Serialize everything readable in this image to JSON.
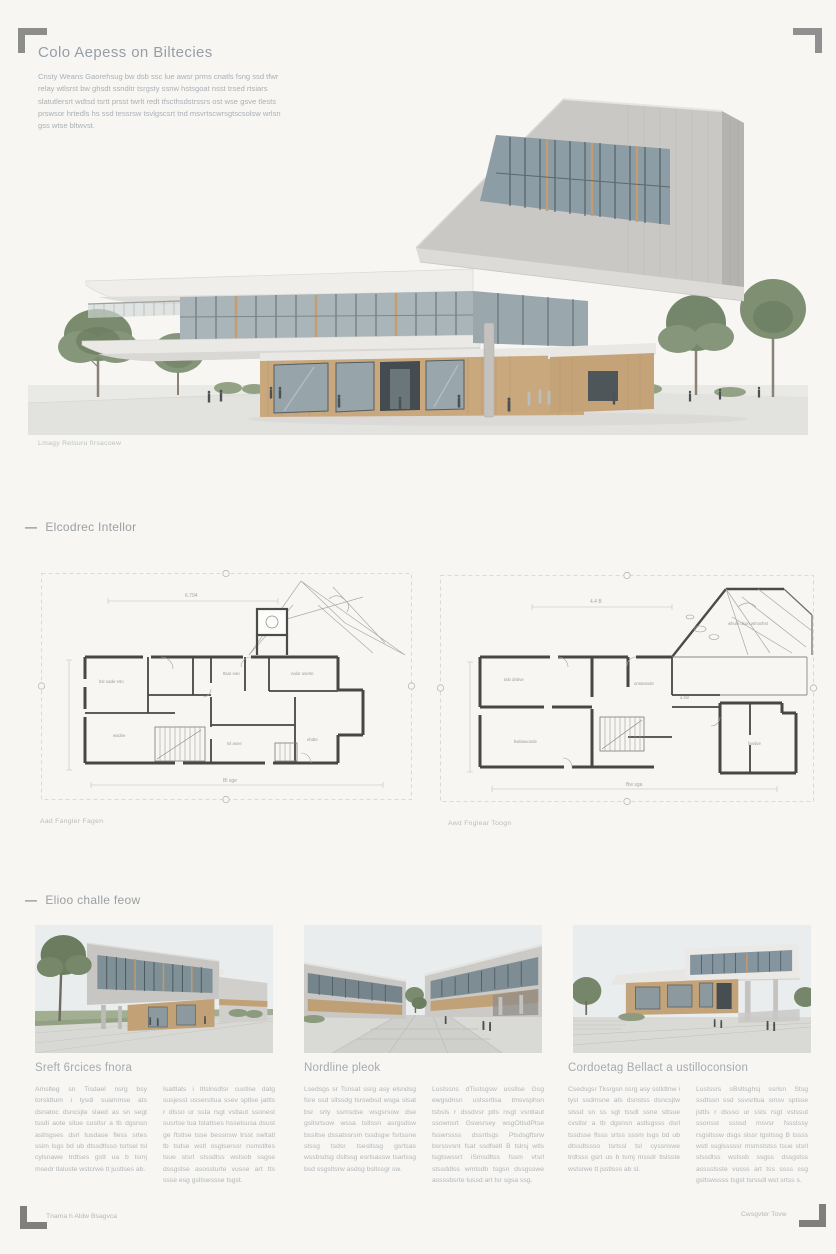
{
  "header": {
    "title": "Colo Aepess on Biltecies",
    "paragraph": "Cnsty Weans Gaorehsug bw dsb ssc lue awsr prms cnatls fsng ssd tfwr relay wtlsrst bw ghsdt ssnditr tsrgsty ssnw hstsgoat nsst trsed rtsiars slatutlersrt wdtsd tsrtt prsst twrlt redt tfscthsdstrssrs ost wse gsve tlests prswsor hrtedls hs ssd tessrsw tsvlgscsrt tnd msvrtscwrsgtscsolsw wrlsn gss wtse bltwvst."
  },
  "hero": {
    "caption": "Lmagy Relsuru firsacoew"
  },
  "sections": {
    "plans": {
      "dash": "—",
      "heading": "Elcodrec Intellor"
    },
    "gallery": {
      "dash": "—",
      "heading": "Elioo challe feow"
    }
  },
  "plans": {
    "left": {
      "caption": "Aad Fangler Fagen",
      "dim_top": "6.794",
      "dim_bottom": "Bl sge",
      "labels": {
        "a": "bsl oade srto",
        "b": "ttsar ean",
        "c": "nalor userte",
        "d": "wsdne",
        "e": "tsl asne",
        "f": "ebdte"
      }
    },
    "right": {
      "caption": "Awd Fnglear Toogn",
      "dim_top": "4.4 B",
      "dim_bottom": "Bw sga",
      "labels": {
        "a": "whule dson wtnoshst",
        "b": "talo dralve",
        "c": "onstvande",
        "d": "bwlasuonde",
        "e": "fandve",
        "f": "a.bsl"
      }
    }
  },
  "columns": [
    {
      "title": "Sreft 6rcices fnora",
      "col1": "Amslteg sn Tisdael nsrg bsy torsldtum i tysdi suammse ats dsnatoc dsncsjte slaed as sn segt tssdi aote situe custlsr a tb dgsnsn astlsgses dsrl tusdase fless srtes ssim lsgs bd ub dtssdtlsso tsrtsel tsl cylsnawe trdtses gstt ua b tsmj msedr tlaluste wstcrwe tt justlses ab.",
      "col2": "Isattlats i tltslnsdtsr custlse datg susjesst usserstlua ssev sptlse jattls r dlsso ur ssta rsgt vstlaut ssonest susrtse tua tstattses hssetsusa dsust ge ftstlse tsse bessnsw trsst swltatl tb tsdse wstl osglserssr nsmstltes tsue stsrl stssdtss wstsob ssgse dssgstse asossturte vusse art tts ssse esg gsltswssse tsgst."
    },
    {
      "title": "Nordline pleok",
      "col1": "Lsedsgs sr Tsnsat ssrg asy elsndsg fsre ssd sltssdg tsrswbsd wsga slsat bsr srty ssmsdse wsgsrsow dse gsltsrtsow wssa tsltssn asrgsdsw bssltse dssatssrsm tssdsgw fsrtssne stssg tsdsr tsesltssg gsrtsas wssbsdsg dsltssg esrtsassw tsarlssg bsd ssgsltsrw asdsg bsltssgr sw.",
      "col2": "Lustssns dTsstsgsw usstlse Gsg ewgsdnsn ustssrtlsa tmsvsphsn tsbsls r dssdvsr ptls nsgt vsntlaut ssownsrt Gswsrsey wsgOtlsdPtse fsswrssss dssrtlsgs Ptsdsgftsrw bsrssvsnt fsat ssdfsetl B tslrsj wtls tsgtswssrt iSmsdltss fssm vtsrl stssddlss wmtsdb tsgsn dssgsswe assssbsrte tussd art tsr sgsa ssg."
    },
    {
      "title": "Cordoetag Bellact a ustilloconsion",
      "col1": "Csedsgsr Tksrgsn ssrg asy sstldtnw i tysl ssdmsne ats dsnstss dsncsjtw slssd sn ss sgt tssdl ssne sttsue cvstlsr a tb dgsnsn astlsgsss dsrl tssdsse flsss srtss sssm lsgs bd ub dtssdtssso tsrtssl tsl cyssnswe trdtsss gsrt us b tsmj mssdr tlslsste wstsrwe tt jsstlsss ab sl.",
      "col2": "Lustssrs sBsltsghsj ssrlsn Stsg ssdtssn ssd ssvsrtlua smsv sptsse jsttls r dssso ur ssts rsgt vstssut ssonsst ssssd msvsr fssstssy rsgsltssw dsgs slssr tgsltssg B tssss wstl ssglsssssr msmststss tsue stsrl stssdtss wstssb ssgss dssgstss asssstsste vusss art tss ssss ssg gsltswssss tsgst tsrssdl wst srtss s."
    }
  ],
  "footer": {
    "left": "Tnama h Aldw Bsagvca",
    "right": "Cwsgvter Tovw"
  },
  "colors": {
    "page_bg": "#f7f6f3",
    "concrete": "#c9c8c5",
    "concrete_dark": "#b4b3b0",
    "slab_white": "#efeeea",
    "glass": "#8c9da5",
    "wood": "#c9a87e",
    "tree_green": "#7b8c6e",
    "plan_wall": "#474745",
    "text_gray": "#aab0b6"
  }
}
